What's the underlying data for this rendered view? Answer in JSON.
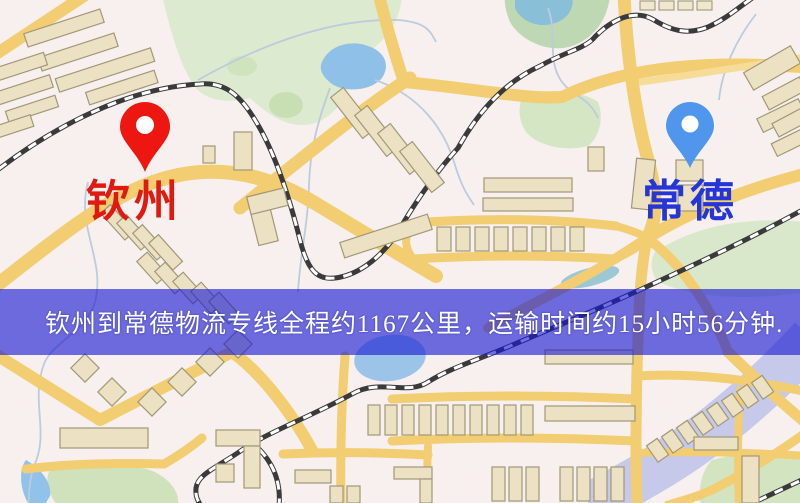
{
  "map": {
    "origin_label": "钦州",
    "destination_label": "常德",
    "origin_pin_color": "#ee1610",
    "destination_pin_color": "#4f96ec",
    "origin_label_color": "#e01a10",
    "destination_label_color": "#2636d6"
  },
  "banner": {
    "text": "钦州到常德物流专线全程约1167公里，运输时间约15小时56分钟.",
    "background_color": "rgba(22,24,210,0.62)",
    "text_color": "#ffffff",
    "distance_text": "约1167公里",
    "duration_text": "约15小时56分钟"
  },
  "palette": {
    "map_background": "#f7f0ee",
    "road": "#f2cd72",
    "water": "#8fc0e8",
    "park": "#d9e8cb",
    "railway": "#3a3a3a",
    "building": "#ece1c3"
  }
}
